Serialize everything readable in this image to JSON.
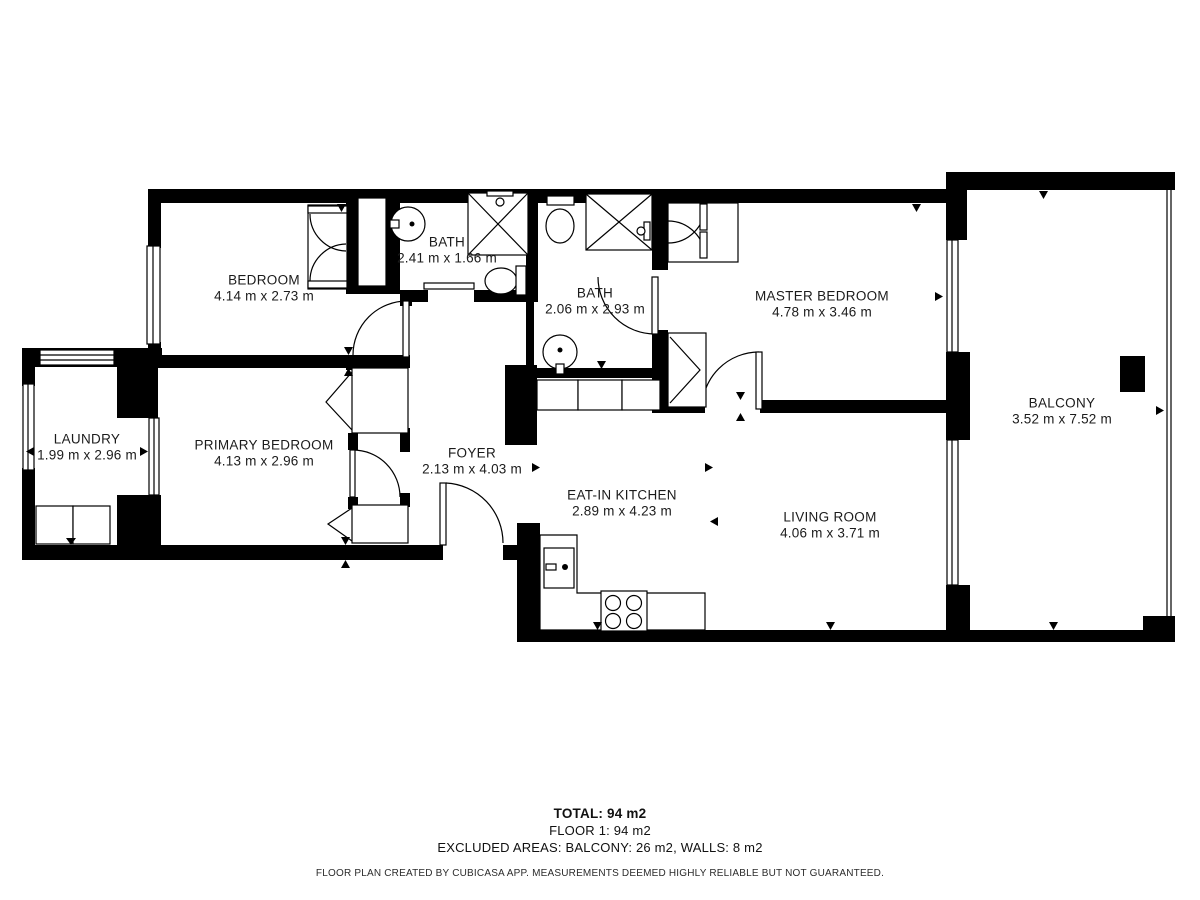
{
  "rooms": [
    {
      "name": "BEDROOM",
      "dims": "4.14 m x 2.73 m"
    },
    {
      "name": "BATH",
      "dims": "2.41 m x 1.66 m"
    },
    {
      "name": "BATH",
      "dims": "2.06 m x 2.93 m"
    },
    {
      "name": "MASTER BEDROOM",
      "dims": "4.78 m x 3.46 m"
    },
    {
      "name": "BALCONY",
      "dims": "3.52 m x 7.52 m"
    },
    {
      "name": "LAUNDRY",
      "dims": "1.99 m x 2.96 m"
    },
    {
      "name": "PRIMARY BEDROOM",
      "dims": "4.13 m x 2.96 m"
    },
    {
      "name": "FOYER",
      "dims": "2.13 m x 4.03 m"
    },
    {
      "name": "EAT-IN KITCHEN",
      "dims": "2.89 m x 4.23 m"
    },
    {
      "name": "LIVING ROOM",
      "dims": "4.06 m x 3.71 m"
    }
  ],
  "summary": {
    "total": "TOTAL: 94 m2",
    "floor": "FLOOR 1: 94 m2",
    "excluded": "EXCLUDED AREAS: BALCONY: 26 m2, WALLS: 8 m2"
  },
  "disclaimer": "FLOOR PLAN CREATED BY CUBICASA APP. MEASUREMENTS DEEMED HIGHLY RELIABLE BUT NOT GUARANTEED.",
  "colors": {
    "wall": "#000000",
    "background": "#ffffff",
    "text": "#1b1b1b"
  }
}
